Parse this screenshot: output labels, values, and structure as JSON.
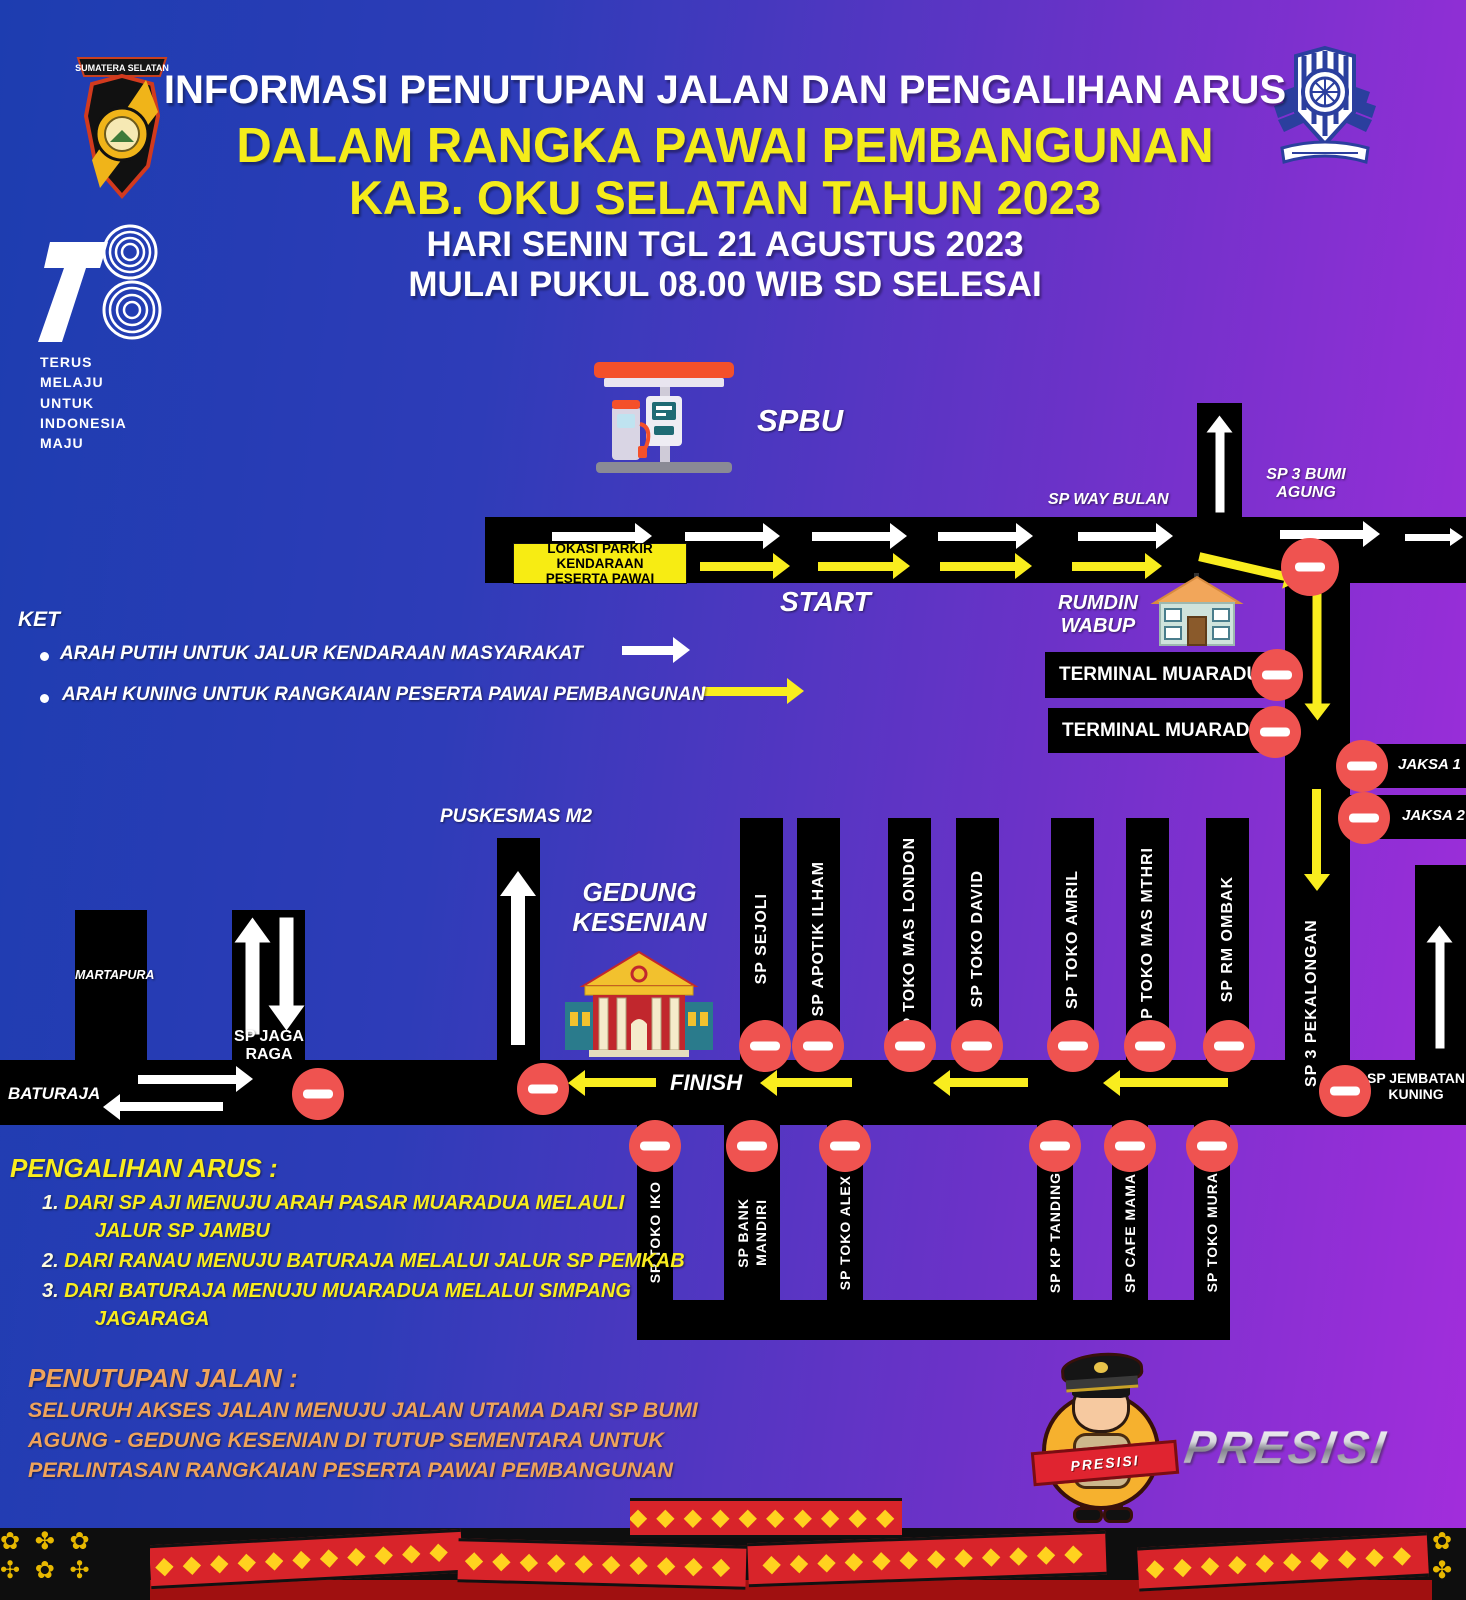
{
  "header": {
    "title_line1": "INFORMASI PENUTUPAN JALAN DAN PENGALIHAN ARUS",
    "title_line2": "DALAM RANGKA PAWAI PEMBANGUNAN",
    "title_line3": "KAB. OKU SELATAN TAHUN 2023",
    "subtitle_line1": "HARI SENIN TGL 21 AGUSTUS 2023",
    "subtitle_line2": "MULAI PUKUL 08.00 WIB SD SELESAI",
    "badge_banner": "SUMATERA SELATAN"
  },
  "logo78": {
    "tagline": [
      "TERUS",
      "MELAJU",
      "UNTUK",
      "INDONESIA",
      "MAJU"
    ]
  },
  "legend": {
    "title": "KET",
    "item_white": "ARAH PUTIH UNTUK JALUR KENDARAAN MASYARAKAT",
    "item_yellow": "ARAH KUNING UNTUK RANGKAIAN PESERTA PAWAI PEMBANGUNAN"
  },
  "map": {
    "spbu": "SPBU",
    "parking": [
      "LOKASI PARKIR KENDARAAN",
      "PESERTA PAWAI"
    ],
    "start": "START",
    "sp_way_bulan": "SP WAY BULAN",
    "sp3_bumi_agung": [
      "SP 3 BUMI",
      "AGUNG"
    ],
    "rumdin_wabup": [
      "RUMDIN",
      "WABUP"
    ],
    "terminal_1": "TERMINAL MUARADUA",
    "terminal_2": "TERMINAL MUARADUA",
    "jaksa_1": "JAKSA 1",
    "jaksa_2": "JAKSA 2",
    "sp3_pekalongan": "SP 3 PEKALONGAN",
    "sp_jembatan_kuning": [
      "SP JEMBATAN",
      "KUNING"
    ],
    "puskesmas": "PUSKESMAS M2",
    "gedung_kesenian": [
      "GEDUNG",
      "KESENIAN"
    ],
    "martapura": "MARTAPURA",
    "baturaja": "BATURAJA",
    "sp_jaga_raga": [
      "SP JAGA",
      "RAGA"
    ],
    "finish": "FINISH",
    "upper_branches": [
      "SP SEJOLI",
      "SP APOTIK ILHAM",
      "SP TOKO MAS LONDON",
      "SP TOKO DAVID",
      "SP TOKO AMRIL",
      "SP TOKO MAS MTHRI",
      "SP RM OMBAK"
    ],
    "lower_branches": [
      [
        "SP TOKO IKO"
      ],
      [
        "SP BANK",
        "MANDIRI"
      ],
      [
        "SP TOKO ALEX"
      ],
      [
        "SP KP TANDING"
      ],
      [
        "SP CAFE MAMA"
      ],
      [
        "SP TOKO MURA"
      ]
    ]
  },
  "notes": {
    "pengalihan_title": "PENGALIHAN ARUS :",
    "pengalihan_items": [
      {
        "num": "1.",
        "line1": "DARI SP AJI MENUJU ARAH PASAR MUARADUA  MELAULI",
        "line2": "JALUR SP JAMBU"
      },
      {
        "num": "2.",
        "line1": "DARI RANAU MENUJU BATURAJA MELALUI JALUR SP PEMKAB",
        "line2": ""
      },
      {
        "num": "3.",
        "line1": "DARI BATURAJA MENUJU MUARADUA MELALUI SIMPANG",
        "line2": "JAGARAGA"
      }
    ],
    "penutupan_title": "PENUTUPAN JALAN :",
    "penutupan_lines": [
      "SELURUH AKSES JALAN MENUJU JALAN UTAMA DARI SP BUMI",
      "AGUNG - GEDUNG KESENIAN DI TUTUP SEMENTARA UNTUK",
      "PERLINTASAN RANGKAIAN PESERTA PAWAI PEMBANGUNAN"
    ]
  },
  "branding": {
    "presisi_wordmark": "PRESISI",
    "mascot_ribbon": "PRESISI"
  },
  "colors": {
    "background_blue": "#1d3db0",
    "background_purple": "#a32ddc",
    "road_black": "#000000",
    "arrow_white": "#ffffff",
    "arrow_yellow": "#F9ED1E",
    "no_entry_red": "#EF5350",
    "title_yellow": "#F4EC1A",
    "penutupan_orange": "#EFA35B",
    "band_red": "#D8242A",
    "diamond_yellow": "#FFD21F"
  }
}
